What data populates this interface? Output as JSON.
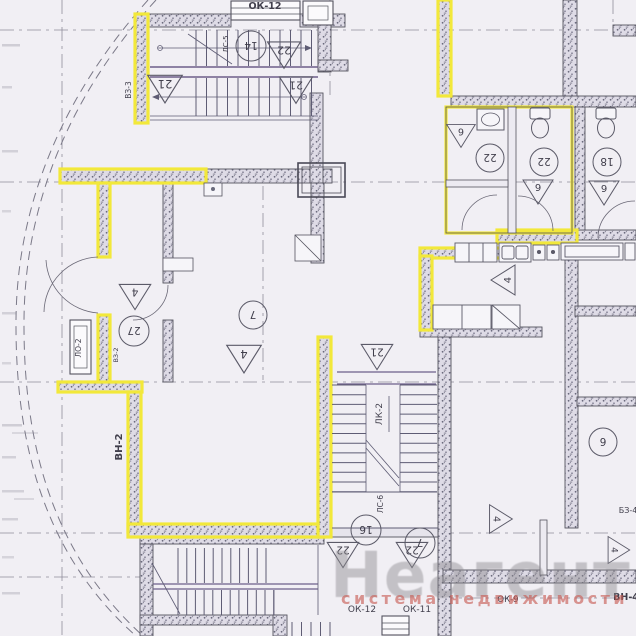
{
  "watermark": {
    "brand": "Неагент",
    "tagline": "система недвижимости"
  },
  "labels": {
    "ok12_top": "ОК-12",
    "ls5": "ЛС-5",
    "vz3": "ВЗ-3",
    "lo2": "ЛО-2",
    "vz2": "ВЗ-2",
    "vn2": "ВН-2",
    "lk2": "ЛК-2",
    "ls6": "ЛС-6",
    "ok12_bottom": "ОК-12",
    "ok11": "ОК-11",
    "ok9": "ОК-9",
    "vn4": "ВН-4",
    "bz4": "БЗ-4"
  },
  "markers": {
    "triangles": [
      {
        "n": "21"
      },
      {
        "n": "22"
      },
      {
        "n": "21"
      },
      {
        "n": "6"
      },
      {
        "n": "6"
      },
      {
        "n": "6"
      },
      {
        "n": "4"
      },
      {
        "n": "4"
      },
      {
        "n": "4"
      },
      {
        "n": "21"
      },
      {
        "n": "22"
      },
      {
        "n": "22"
      },
      {
        "n": "4"
      },
      {
        "n": "4"
      }
    ],
    "circles": [
      {
        "n": "14"
      },
      {
        "n": "22"
      },
      {
        "n": "22"
      },
      {
        "n": "18"
      },
      {
        "n": "27"
      },
      {
        "n": "7"
      },
      {
        "n": "16"
      },
      {
        "n": "7"
      },
      {
        "n": "6"
      }
    ]
  },
  "colors": {
    "highlight_yellow": "#f2e83a",
    "paper": "#f1eff4",
    "wall_line": "#55545f",
    "stair_line": "#5e5c74",
    "axis_line": "#8f8d9a",
    "watermark_gray": "#8c898e",
    "watermark_red": "#c65850"
  }
}
